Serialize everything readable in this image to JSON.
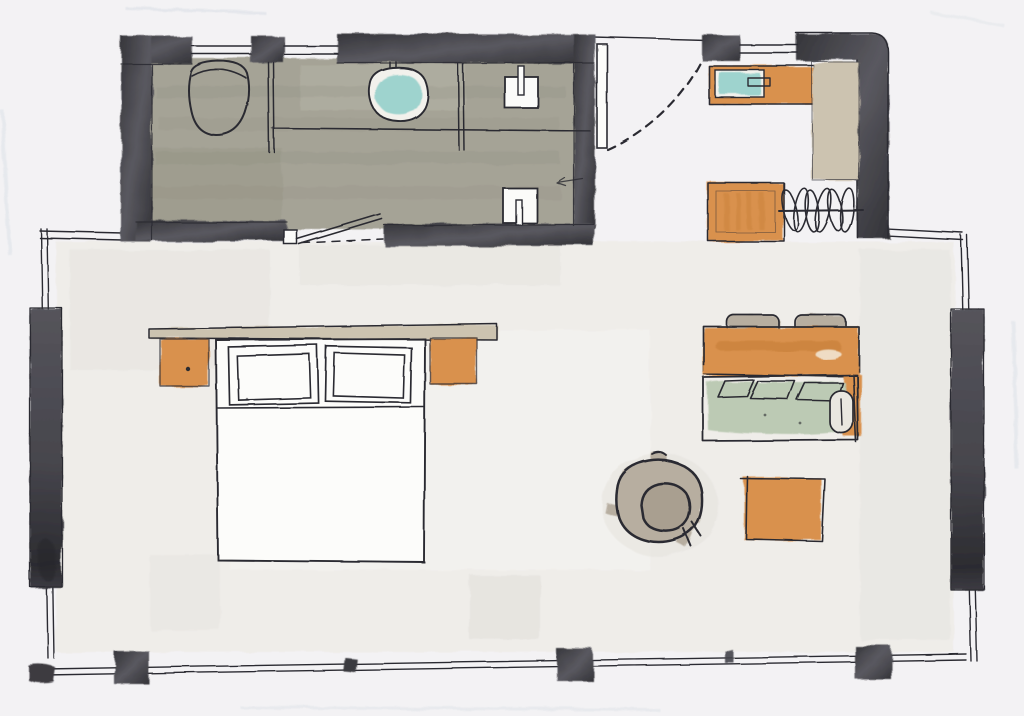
{
  "meta": {
    "kind": "hand-drawn watercolor floor plan sketch",
    "subject": "studio hotel room with bathroom, entry, closet, bedroom and lounge"
  },
  "palette": {
    "paper": "#f3f2f4",
    "ink": "#2c2c31",
    "wall_dark": "#4a494f",
    "wall_dark_edge": "#2f2f34",
    "floor_olive": "#a5a396",
    "floor_olive_deep": "#8f8e80",
    "orange": "#d9914e",
    "orange_deep": "#c37a36",
    "teal": "#9ed3ce",
    "sage": "#bccab4",
    "sage_light": "#cdd7c5",
    "tan": "#ccc3b0",
    "taupe": "#b7aea0",
    "taupe_deep": "#a99f90",
    "white_paper": "#fcfcfa",
    "wash_warm": "#eceae4",
    "streak_blue": "#d9dee5"
  },
  "plan": {
    "areas": [
      {
        "id": "bathroom",
        "features": [
          "toilet",
          "toilet-partition",
          "vanity-counter",
          "washbasin",
          "faucet",
          "shower-partition",
          "shower-valve-upper",
          "shower-valve-lower",
          "direction-arrow",
          "bathroom-door"
        ]
      },
      {
        "id": "entry",
        "features": [
          "entry-door-leaf",
          "door-swing-arc"
        ]
      },
      {
        "id": "closet",
        "features": [
          "minibar-counter",
          "minibar-sink",
          "handle",
          "tall-cabinet",
          "dresser",
          "hanging-rail",
          "clothes-hangers"
        ]
      },
      {
        "id": "bedroom",
        "features": [
          "headboard",
          "nightstand-left",
          "nightstand-right",
          "double-bed",
          "pillow-left",
          "pillow-right"
        ]
      },
      {
        "id": "lounge",
        "features": [
          "console-table",
          "chair-left",
          "chair-right",
          "sofa",
          "sofa-cushion",
          "back-pillows",
          "bolster",
          "armchair",
          "side-table"
        ]
      },
      {
        "id": "envelope",
        "features": [
          "outer-walls",
          "window-panel-left",
          "window-panel-right",
          "wall-posts-bottom",
          "wall-posts-top",
          "corner-marks"
        ]
      }
    ]
  }
}
